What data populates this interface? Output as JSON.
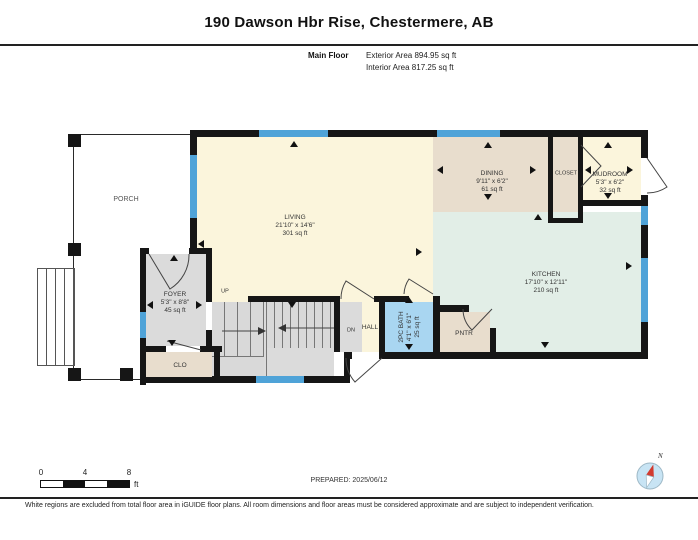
{
  "header": {
    "title": "190 Dawson Hbr Rise, Chestermere, AB",
    "floor_label": "Main Floor",
    "exterior_area": "Exterior Area 894.95 sq ft",
    "interior_area": "Interior Area 817.25 sq ft"
  },
  "rooms": {
    "porch": {
      "name": "PORCH"
    },
    "living": {
      "name": "LIVING",
      "dims": "21'10\" x 14'6\"",
      "area": "301 sq ft"
    },
    "dining": {
      "name": "DINING",
      "dims": "9'11\" x 6'2\"",
      "area": "61 sq ft"
    },
    "closet": {
      "name": "CLOSET"
    },
    "mudroom": {
      "name": "MUDROOM",
      "dims": "5'3\" x 6'2\"",
      "area": "32 sq ft"
    },
    "kitchen": {
      "name": "KITCHEN",
      "dims": "17'10\" x 12'11\"",
      "area": "210 sq ft"
    },
    "foyer": {
      "name": "FOYER",
      "dims": "5'3\" x 8'8\"",
      "area": "45 sq ft"
    },
    "bath": {
      "name": "2PC BATH",
      "dims": "4'1\" x 6'1\"",
      "area": "25 sq ft"
    },
    "hall": {
      "name": "HALL"
    },
    "pantry": {
      "name": "PNTR"
    },
    "clo": {
      "name": "CLO"
    },
    "stairs_up": "UP",
    "stairs_dn": "DN"
  },
  "scale_bar": {
    "tick0": "0",
    "tick1": "4",
    "tick2": "8",
    "unit": "ft"
  },
  "prepared": "PREPARED: 2025/06/12",
  "compass": {
    "label": "N"
  },
  "footer": "White regions are excluded from total floor area in iGUIDE floor plans. All room dimensions and floor areas must be considered approximate and are subject to independent verification.",
  "colors": {
    "wall": "#161616",
    "window": "#4FA3D8",
    "living_cream": "#FBF5DC",
    "dining_tan": "#E8DDCD",
    "kitchen_mint": "#E2EEE7",
    "bath_blue": "#A9D6F1",
    "stair_gray": "#DBDBDB"
  }
}
